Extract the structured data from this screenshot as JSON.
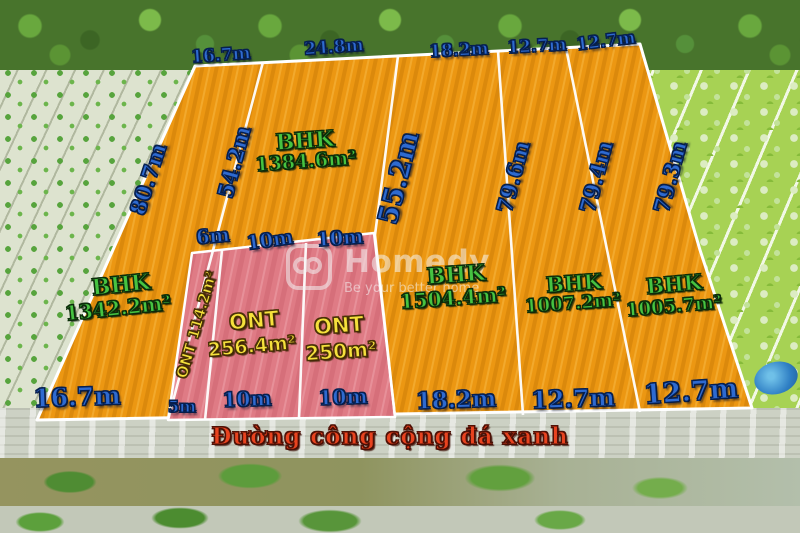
{
  "watermark": {
    "brand": "Homedy",
    "tagline": "Be your better home"
  },
  "road": {
    "label": "Đường công cộng đá xanh"
  },
  "colors": {
    "plot_orange": "#EC9712",
    "plot_pink": "#DF7B85",
    "boundary_white": "#FFFFFF",
    "dimension_blue": "#2E6AD0",
    "area_green": "#46C341",
    "area_yellow": "#F5E13C",
    "road_red": "#E8431F"
  },
  "labels": [
    {
      "text": "16.7m",
      "x": 221,
      "y": 56,
      "rot": -4,
      "size": 17,
      "cls": "dim",
      "name": "dim-top-plot1"
    },
    {
      "text": "24.8m",
      "x": 334,
      "y": 48,
      "rot": -4,
      "size": 17,
      "cls": "dim",
      "name": "dim-top-plot2"
    },
    {
      "text": "18.2m",
      "x": 459,
      "y": 51,
      "rot": -3,
      "size": 17,
      "cls": "dim",
      "name": "dim-top-plot3"
    },
    {
      "text": "12.7m",
      "x": 537,
      "y": 47,
      "rot": -3,
      "size": 17,
      "cls": "dim",
      "name": "dim-top-plot4"
    },
    {
      "text": "12.7m",
      "x": 606,
      "y": 42,
      "rot": -7,
      "size": 17,
      "cls": "dim",
      "name": "dim-top-plot5"
    },
    {
      "text": "80.7m",
      "x": 148,
      "y": 179,
      "rot": -72,
      "size": 21,
      "cls": "dim",
      "name": "dim-side-left-edge"
    },
    {
      "text": "54.2m",
      "x": 234,
      "y": 162,
      "rot": -75,
      "size": 21,
      "cls": "dim",
      "name": "dim-side-divider1"
    },
    {
      "text": "55.2m",
      "x": 399,
      "y": 178,
      "rot": -76,
      "size": 27,
      "cls": "dim",
      "name": "dim-side-divider2"
    },
    {
      "text": "79.6m",
      "x": 513,
      "y": 177,
      "rot": -75,
      "size": 21,
      "cls": "dim",
      "name": "dim-side-divider3"
    },
    {
      "text": "79.4m",
      "x": 596,
      "y": 177,
      "rot": -75,
      "size": 21,
      "cls": "dim",
      "name": "dim-side-divider4"
    },
    {
      "text": "79.3m",
      "x": 670,
      "y": 177,
      "rot": -75,
      "size": 21,
      "cls": "dim",
      "name": "dim-side-right-edge"
    },
    {
      "text": "6m",
      "x": 213,
      "y": 237,
      "rot": -5,
      "size": 19,
      "cls": "dim",
      "name": "dim-mid-6m"
    },
    {
      "text": "10m",
      "x": 270,
      "y": 241,
      "rot": -8,
      "size": 19,
      "cls": "dim",
      "name": "dim-mid-10m-a"
    },
    {
      "text": "10m",
      "x": 340,
      "y": 239,
      "rot": -4,
      "size": 19,
      "cls": "dim",
      "name": "dim-mid-10m-b"
    },
    {
      "text": "16.7m",
      "x": 77,
      "y": 397,
      "rot": -2,
      "size": 25,
      "cls": "dim",
      "name": "dim-bottom-plot1"
    },
    {
      "text": "5m",
      "x": 182,
      "y": 407,
      "rot": 0,
      "size": 16,
      "cls": "dim",
      "name": "dim-bottom-5m"
    },
    {
      "text": "10m",
      "x": 247,
      "y": 399,
      "rot": -2,
      "size": 20,
      "cls": "dim",
      "name": "dim-bottom-10m-a"
    },
    {
      "text": "10m",
      "x": 343,
      "y": 397,
      "rot": -2,
      "size": 20,
      "cls": "dim",
      "name": "dim-bottom-10m-b"
    },
    {
      "text": "18.2m",
      "x": 456,
      "y": 400,
      "rot": -2,
      "size": 23,
      "cls": "dim",
      "name": "dim-bottom-plot3"
    },
    {
      "text": "12.7m",
      "x": 573,
      "y": 399,
      "rot": -2,
      "size": 24,
      "cls": "dim",
      "name": "dim-bottom-plot4"
    },
    {
      "text": "12.7m",
      "x": 691,
      "y": 392,
      "rot": -4,
      "size": 27,
      "cls": "dim",
      "name": "dim-bottom-plot5"
    },
    {
      "text": "BHK",
      "x": 121,
      "y": 285,
      "rot": -6,
      "size": 22,
      "cls": "area-g",
      "name": "plot1-type"
    },
    {
      "text": "1342.2m²",
      "x": 118,
      "y": 308,
      "rot": -6,
      "size": 20,
      "cls": "area-g",
      "name": "plot1-area"
    },
    {
      "text": "BHK",
      "x": 305,
      "y": 141,
      "rot": -4,
      "size": 22,
      "cls": "area-g",
      "name": "plot2-type"
    },
    {
      "text": "1384.6m²",
      "x": 306,
      "y": 162,
      "rot": -4,
      "size": 19,
      "cls": "area-g",
      "name": "plot2-area"
    },
    {
      "text": "ONT 114.2m²",
      "x": 197,
      "y": 325,
      "rot": -74,
      "size": 15,
      "cls": "area-y",
      "name": "plot-ont1-label"
    },
    {
      "text": "ONT",
      "x": 254,
      "y": 321,
      "rot": -5,
      "size": 21,
      "cls": "area-y",
      "name": "plot-ont2-type"
    },
    {
      "text": "256.4m²",
      "x": 252,
      "y": 347,
      "rot": -5,
      "size": 19,
      "cls": "area-y",
      "name": "plot-ont2-area"
    },
    {
      "text": "ONT",
      "x": 339,
      "y": 326,
      "rot": -4,
      "size": 21,
      "cls": "area-y",
      "name": "plot-ont3-type"
    },
    {
      "text": "250m²",
      "x": 341,
      "y": 351,
      "rot": -4,
      "size": 20,
      "cls": "area-y",
      "name": "plot-ont3-area"
    },
    {
      "text": "BHK",
      "x": 456,
      "y": 275,
      "rot": -4,
      "size": 22,
      "cls": "area-g",
      "name": "plot3-type"
    },
    {
      "text": "1504.4m²",
      "x": 453,
      "y": 298,
      "rot": -4,
      "size": 20,
      "cls": "area-g",
      "name": "plot3-area"
    },
    {
      "text": "BHK",
      "x": 574,
      "y": 283,
      "rot": -4,
      "size": 21,
      "cls": "area-g",
      "name": "plot4-type"
    },
    {
      "text": "1007.2m²",
      "x": 573,
      "y": 304,
      "rot": -4,
      "size": 18,
      "cls": "area-g",
      "name": "plot4-area"
    },
    {
      "text": "BHK",
      "x": 674,
      "y": 284,
      "rot": -5,
      "size": 21,
      "cls": "area-g",
      "name": "plot5-type"
    },
    {
      "text": "1005.7m²",
      "x": 674,
      "y": 307,
      "rot": -5,
      "size": 18,
      "cls": "area-g",
      "name": "plot5-area"
    }
  ]
}
